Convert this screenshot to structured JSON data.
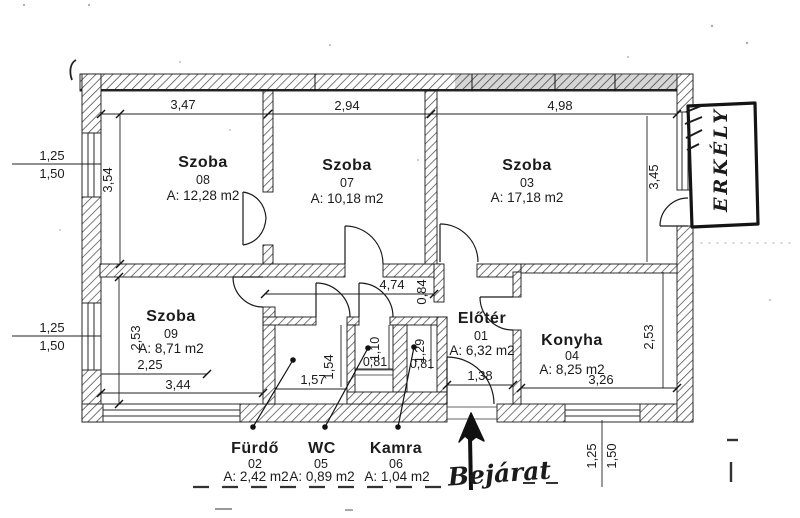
{
  "plan": {
    "rooms": {
      "szoba08": {
        "name": "Szoba",
        "number": "08",
        "area": "A: 12,28 m2"
      },
      "szoba07": {
        "name": "Szoba",
        "number": "07",
        "area": "A: 10,18 m2"
      },
      "szoba03": {
        "name": "Szoba",
        "number": "03",
        "area": "A: 17,18 m2"
      },
      "szoba09": {
        "name": "Szoba",
        "number": "09",
        "area": "A: 8,71 m2"
      },
      "eloter": {
        "name": "Előtér",
        "number": "01",
        "area": "A: 6,32 m2"
      },
      "konyha": {
        "name": "Konyha",
        "number": "04",
        "area": "A: 8,25 m2"
      },
      "furdo": {
        "name": "Fürdő",
        "number": "02",
        "area": "A: 2,42 m2"
      },
      "wc": {
        "name": "WC",
        "number": "05",
        "area": "A: 0,89 m2"
      },
      "kamra": {
        "name": "Kamra",
        "number": "06",
        "area": "A: 1,04 m2"
      }
    },
    "handwritten": {
      "balcony": "ERKÉLY",
      "entrance": "Bejárat"
    },
    "dims": {
      "szoba08": {
        "w": "3,47",
        "h": "3,54"
      },
      "szoba07": {
        "w": "2,94"
      },
      "szoba03": {
        "w": "4,98",
        "h": "3,45"
      },
      "corridor": {
        "w": "4,74",
        "h": "0,84"
      },
      "szoba09": {
        "h": "2,53",
        "w_partial": "2,25",
        "w": "3,44"
      },
      "furdo": {
        "w": "1,57",
        "h": "1,54"
      },
      "wc": {
        "w": "0,81",
        "h": "1,10"
      },
      "kamra": {
        "w": "0,81",
        "h": "1,29"
      },
      "eloter": {
        "entry_w": "1,38"
      },
      "konyha": {
        "w": "3,26",
        "h": "2,53"
      }
    },
    "windows": {
      "left_top": {
        "a": "1,25",
        "b": "1,50"
      },
      "left_bottom": {
        "a": "1,25",
        "b": "1,50"
      },
      "kitchen": {
        "a": "1,25",
        "b": "1,50"
      }
    }
  }
}
